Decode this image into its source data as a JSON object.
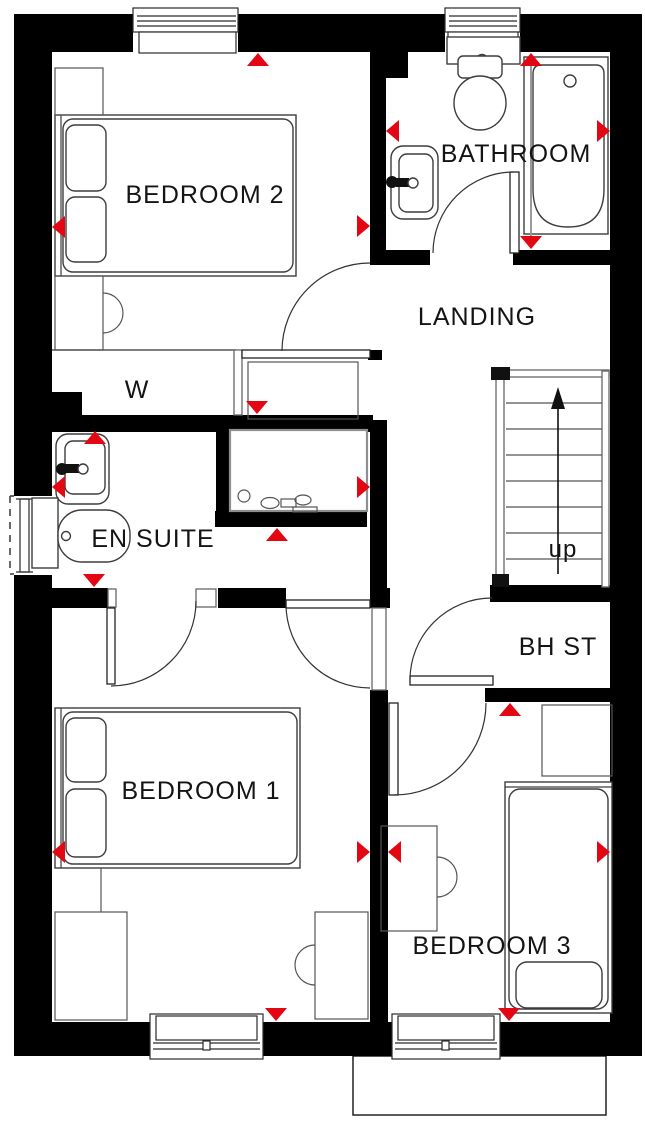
{
  "rooms": {
    "bedroom2": {
      "label": "BEDROOM 2",
      "fixtures": [
        "double-bed",
        "bedside-table",
        "desk-with-chair"
      ]
    },
    "bathroom": {
      "label": "BATHROOM",
      "fixtures": [
        "toilet",
        "bathtub",
        "basin"
      ]
    },
    "landing": {
      "label": "LANDING",
      "fixtures": [
        "storage-recess"
      ]
    },
    "wardrobe": {
      "label": "W"
    },
    "ensuite": {
      "label": "EN SUITE",
      "fixtures": [
        "basin",
        "toilet",
        "shower-enclosure"
      ]
    },
    "stairs": {
      "up_label": "up",
      "tread_count": 8,
      "direction": "up"
    },
    "bhst": {
      "label": "BH ST"
    },
    "bedroom1": {
      "label": "BEDROOM 1",
      "fixtures": [
        "double-bed",
        "wardrobe-unit",
        "desk-with-chair"
      ]
    },
    "bedroom3": {
      "label": "BEDROOM 3",
      "fixtures": [
        "single-bed",
        "bedside-table",
        "desk-with-chair"
      ]
    }
  },
  "windows": [
    "bedroom2-north",
    "bathroom-north",
    "ensuite-west",
    "bedroom1-south",
    "bedroom3-south"
  ],
  "dimension_markers": {
    "count": 20,
    "color": "#e30613"
  },
  "colors": {
    "wall": "#000000",
    "marker_red": "#e30613",
    "label_text": "#141414",
    "furniture_line": "#3d3d3d",
    "background": "#ffffff"
  }
}
